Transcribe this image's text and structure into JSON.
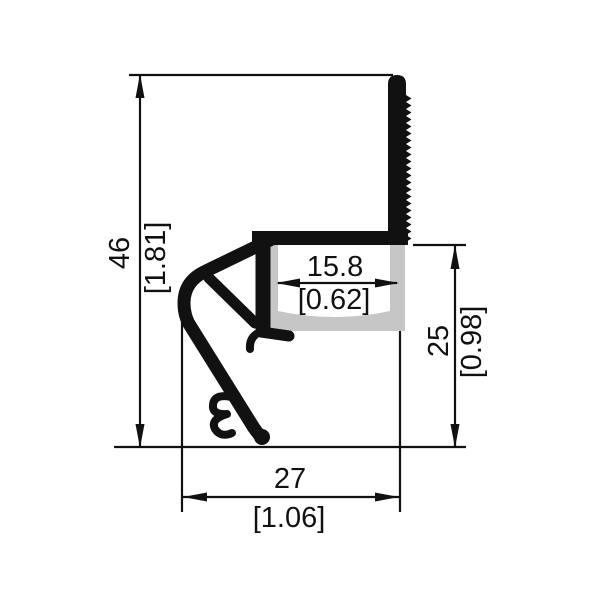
{
  "drawing": {
    "kind": "extrusion-profile-cross-section",
    "colors": {
      "background": "#ffffff",
      "line": "#111111",
      "profile": "#111111",
      "diffuser": "#c6c6c6"
    },
    "dimensions": {
      "overall_height": {
        "metric": "46",
        "imperial": "[1.81]"
      },
      "inner_width": {
        "metric": "15.8",
        "imperial": "[0.62]"
      },
      "right_height": {
        "metric": "25",
        "imperial": "[0.98]"
      },
      "bottom_width": {
        "metric": "27",
        "imperial": "[1.06]"
      }
    }
  }
}
